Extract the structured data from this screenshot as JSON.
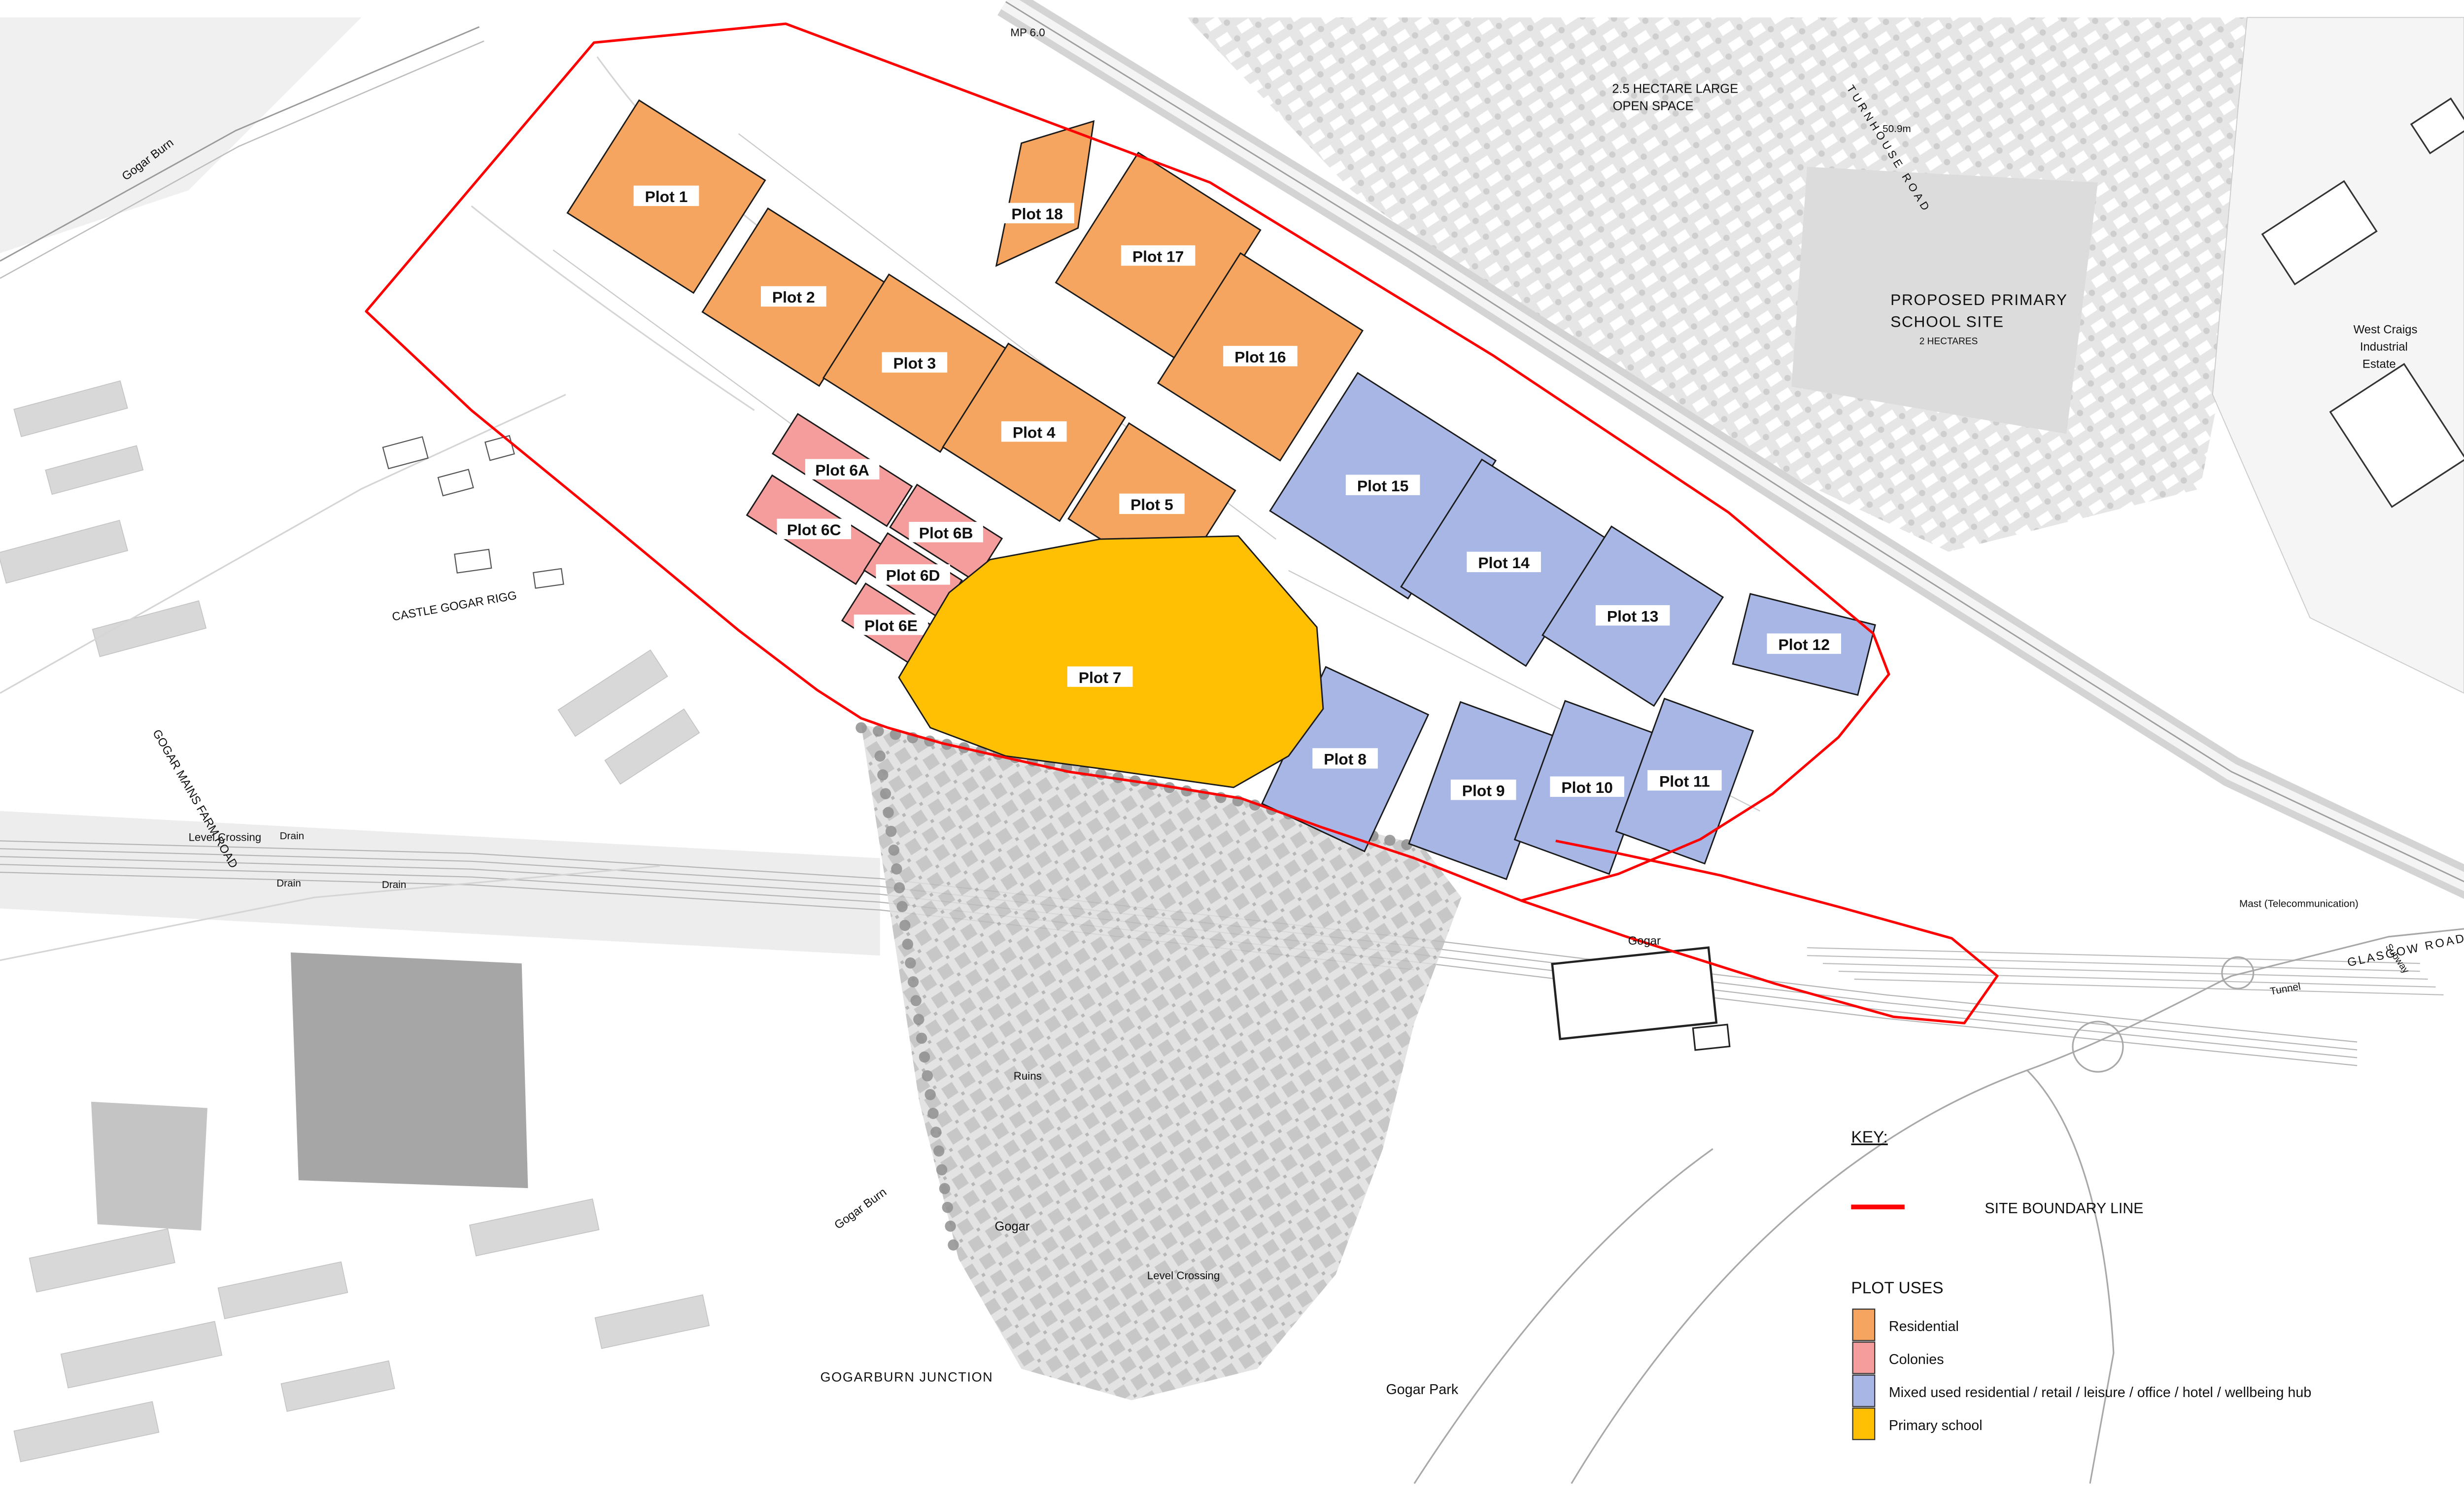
{
  "map": {
    "colors": {
      "residential": "#F5A55F",
      "colonies": "#F59C9C",
      "mixed": "#A7B6E5",
      "school": "#FFC003",
      "boundary": "#FE0000"
    },
    "plots": {
      "p1": "Plot 1",
      "p2": "Plot 2",
      "p3": "Plot 3",
      "p4": "Plot 4",
      "p5": "Plot 5",
      "p6a": "Plot 6A",
      "p6b": "Plot 6B",
      "p6c": "Plot 6C",
      "p6d": "Plot 6D",
      "p6e": "Plot 6E",
      "p7": "Plot 7",
      "p8": "Plot 8",
      "p9": "Plot 9",
      "p10": "Plot 10",
      "p11": "Plot 11",
      "p12": "Plot 12",
      "p13": "Plot 13",
      "p14": "Plot 14",
      "p15": "Plot 15",
      "p16": "Plot 16",
      "p17": "Plot 17",
      "p18": "Plot 18"
    },
    "labels": {
      "gogar_burn_upper": "Gogar Burn",
      "gogar_mains_farm_road": "GOGAR MAINS FARM ROAD",
      "level_crossing_west": "Level Crossing",
      "drain_1": "Drain",
      "drain_2": "Drain",
      "drain_3": "Drain",
      "castle_gogar_rigg": "CASTLE GOGAR RIGG",
      "mp_marker": "MP 6.0",
      "open_space_l1": "2.5 HECTARE LARGE",
      "open_space_l2": "OPEN SPACE",
      "turnhouse_road": "TURNHOUSE ROAD",
      "spot_height": "50.9m",
      "school_l1": "PROPOSED PRIMARY",
      "school_l2": "SCHOOL SITE",
      "school_l3": "2 HECTARES",
      "industrial_l1": "West Craigs",
      "industrial_l2": "Industrial",
      "industrial_l3": "Estate",
      "ruins": "Ruins",
      "gogar_burn_lower": "Gogar Burn",
      "gogar_village": "Gogar",
      "level_crossing_mid": "Level Crossing",
      "gogar_station": "Gogar",
      "gogarburn_junction": "GOGARBURN JUNCTION",
      "gogar_park": "Gogar Park",
      "glasgow_road": "GLASGOW ROAD",
      "tunnel": "Tunnel",
      "subway": "Subway",
      "mast": "Mast (Telecommunication)"
    }
  },
  "legend": {
    "key_title": "KEY:",
    "boundary_label": "SITE BOUNDARY LINE",
    "plot_uses_title": "PLOT USES",
    "items": [
      {
        "label": "Residential",
        "color": "#F5A55F"
      },
      {
        "label": "Colonies",
        "color": "#F59C9C"
      },
      {
        "label": "Mixed used residential / retail / leisure / office / hotel / wellbeing hub",
        "color": "#A7B6E5"
      },
      {
        "label": "Primary school",
        "color": "#FFC003"
      }
    ]
  }
}
